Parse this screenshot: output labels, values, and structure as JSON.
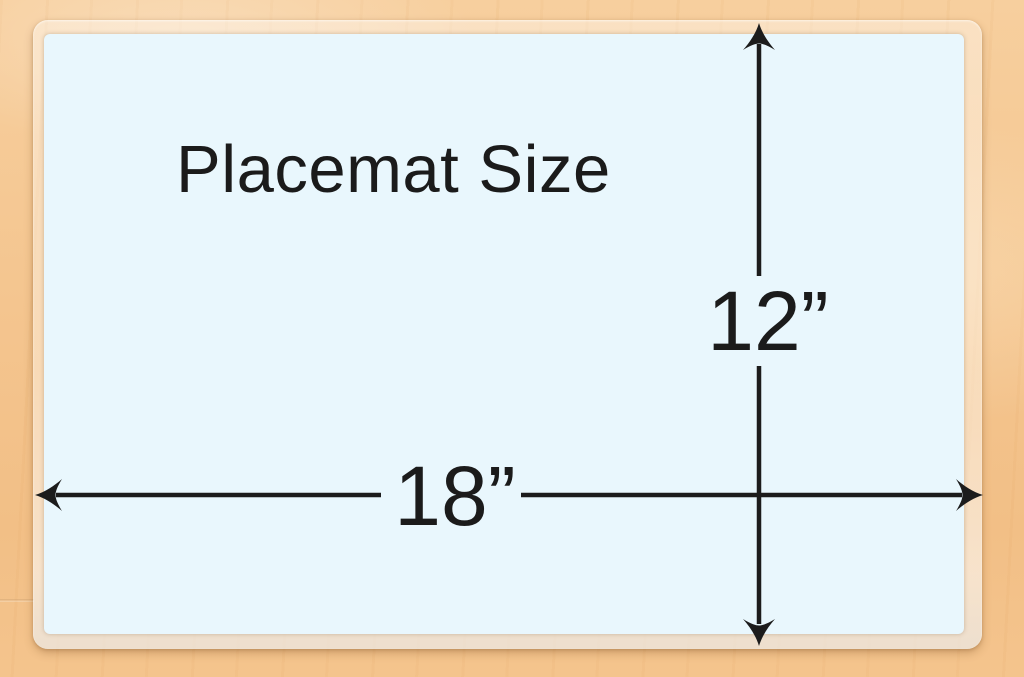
{
  "diagram": {
    "title": "Placemat Size",
    "width_label": "18”",
    "height_label": "12”",
    "width_value": "18",
    "height_value": "12"
  },
  "icons": {
    "arrowheads": [
      "arrowhead-up-icon",
      "arrowhead-down-icon",
      "arrowhead-left-icon",
      "arrowhead-right-icon"
    ]
  },
  "colors": {
    "mat_surface": "#e9f7fd",
    "dimension_line": "#1c1c1c",
    "label_text": "#1b1b1b",
    "wood_light": "#f7cf9e",
    "wood_dark": "#f2bf86",
    "laminate_border": "rgba(255,255,255,0.5)"
  }
}
